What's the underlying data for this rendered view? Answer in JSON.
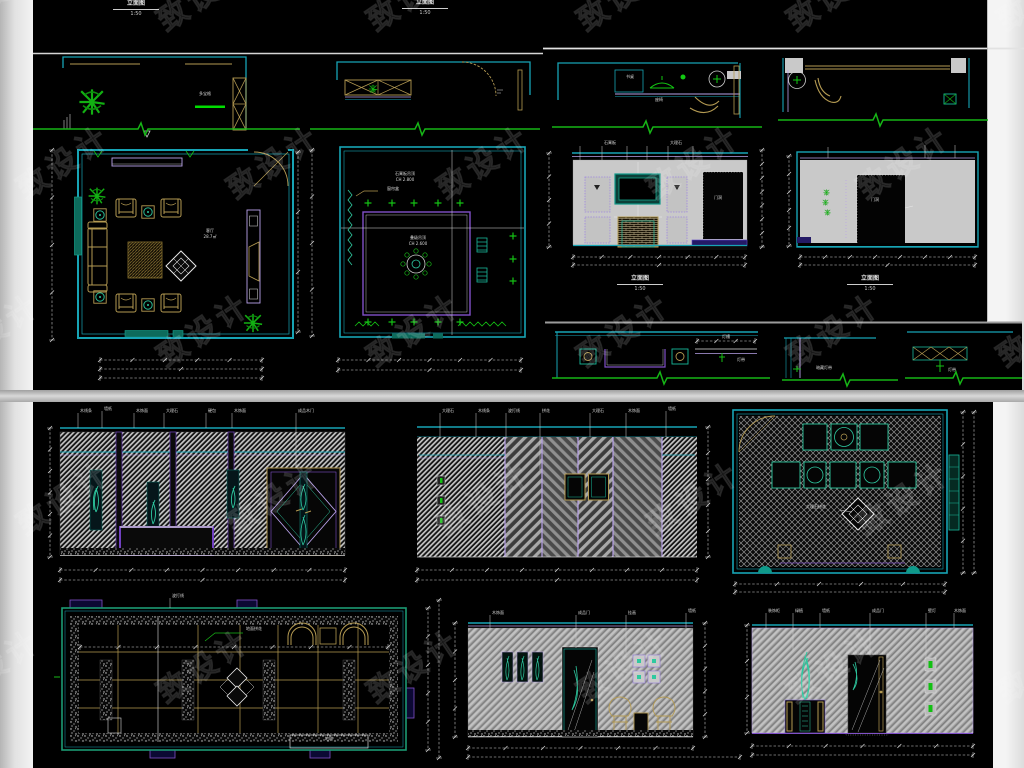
{
  "palette": {
    "sheet_bg": "#000000",
    "page_bg": "#e9e9e9",
    "wall_cyan": "#17a4b5",
    "teal": "#2ec9a0",
    "green": "#16b516",
    "tan": "#b49a52",
    "purple": "#8050c8",
    "lavender": "#b9a2ea",
    "dim_white": "#d8d8d8",
    "wall_gray": "#c9c9c9"
  },
  "watermark": {
    "text": "致设计"
  },
  "titles": {
    "top_title_1": {
      "name": "立面图",
      "scale": "1:50"
    },
    "top_title_2": {
      "name": "立面图",
      "scale": "1:50"
    },
    "elev_a": {
      "name": "立面图",
      "scale": "1:50"
    },
    "elev_b": {
      "name": "立面图",
      "scale": "1:50"
    }
  },
  "annotations": [
    {
      "x": 205,
      "y": 92,
      "t": "多宝格"
    },
    {
      "x": 626,
      "y": 75,
      "t": "书桌",
      "l": 1
    },
    {
      "x": 655,
      "y": 98,
      "t": "座椅",
      "l": 1
    },
    {
      "x": 210,
      "y": 229,
      "t": "客厅"
    },
    {
      "x": 210,
      "y": 235,
      "t": "28.7㎡"
    },
    {
      "x": 405,
      "y": 172,
      "t": "石膏板吊顶"
    },
    {
      "x": 405,
      "y": 178,
      "t": "CH 2.800"
    },
    {
      "x": 387,
      "y": 187,
      "t": "窗帘盒",
      "l": 1
    },
    {
      "x": 418,
      "y": 236,
      "t": "叠级吊顶"
    },
    {
      "x": 418,
      "y": 242,
      "t": "CH 2.600"
    },
    {
      "x": 714,
      "y": 196,
      "t": "门洞",
      "l": 1
    },
    {
      "x": 875,
      "y": 198,
      "t": "门洞"
    },
    {
      "x": 726,
      "y": 335,
      "t": "灯槽"
    },
    {
      "x": 737,
      "y": 358,
      "t": "灯带",
      "l": 1
    },
    {
      "x": 816,
      "y": 366,
      "t": "暗藏灯带",
      "l": 1
    },
    {
      "x": 948,
      "y": 368,
      "t": "灯带",
      "l": 1
    },
    {
      "x": 604,
      "y": 141,
      "t": "石膏板",
      "l": 1
    },
    {
      "x": 670,
      "y": 141,
      "t": "大理石",
      "l": 1
    },
    {
      "x": 80,
      "y": 409,
      "t": "木线条",
      "l": 1
    },
    {
      "x": 104,
      "y": 407,
      "t": "墙纸",
      "l": 1
    },
    {
      "x": 136,
      "y": 409,
      "t": "木饰面",
      "l": 1
    },
    {
      "x": 166,
      "y": 409,
      "t": "大理石",
      "l": 1
    },
    {
      "x": 208,
      "y": 409,
      "t": "硬包",
      "l": 1
    },
    {
      "x": 234,
      "y": 409,
      "t": "木饰面",
      "l": 1
    },
    {
      "x": 298,
      "y": 409,
      "t": "成品木门",
      "l": 1
    },
    {
      "x": 442,
      "y": 409,
      "t": "大理石",
      "l": 1
    },
    {
      "x": 478,
      "y": 409,
      "t": "木线条",
      "l": 1
    },
    {
      "x": 508,
      "y": 409,
      "t": "波打线",
      "l": 1
    },
    {
      "x": 542,
      "y": 409,
      "t": "拼花",
      "l": 1
    },
    {
      "x": 592,
      "y": 409,
      "t": "大理石",
      "l": 1
    },
    {
      "x": 628,
      "y": 409,
      "t": "木饰面",
      "l": 1
    },
    {
      "x": 668,
      "y": 407,
      "t": "墙纸",
      "l": 1
    },
    {
      "x": 806,
      "y": 505,
      "t": "大理石拼花",
      "l": 1
    },
    {
      "x": 246,
      "y": 627,
      "t": "地面拼花",
      "l": 1
    },
    {
      "x": 172,
      "y": 594,
      "t": "波打线",
      "l": 1
    },
    {
      "x": 329,
      "y": 737,
      "t": "地毯"
    },
    {
      "x": 492,
      "y": 611,
      "t": "木饰面",
      "l": 1
    },
    {
      "x": 578,
      "y": 611,
      "t": "成品门",
      "l": 1
    },
    {
      "x": 628,
      "y": 611,
      "t": "挂画",
      "l": 1
    },
    {
      "x": 688,
      "y": 609,
      "t": "墙纸",
      "l": 1
    },
    {
      "x": 768,
      "y": 609,
      "t": "装饰柜",
      "l": 1
    },
    {
      "x": 795,
      "y": 609,
      "t": "绿植",
      "l": 1
    },
    {
      "x": 822,
      "y": 609,
      "t": "墙纸",
      "l": 1
    },
    {
      "x": 872,
      "y": 609,
      "t": "成品门",
      "l": 1
    },
    {
      "x": 928,
      "y": 609,
      "t": "壁灯",
      "l": 1
    },
    {
      "x": 954,
      "y": 609,
      "t": "木饰面",
      "l": 1
    }
  ],
  "leaders": [
    [
      78,
      413,
      428
    ],
    [
      102,
      411,
      428
    ],
    [
      134,
      413,
      428
    ],
    [
      164,
      413,
      428
    ],
    [
      206,
      413,
      428
    ],
    [
      232,
      413,
      428
    ],
    [
      296,
      413,
      468
    ],
    [
      440,
      413,
      437
    ],
    [
      476,
      413,
      437
    ],
    [
      506,
      413,
      437
    ],
    [
      540,
      413,
      470
    ],
    [
      590,
      413,
      437
    ],
    [
      626,
      413,
      437
    ],
    [
      666,
      411,
      437
    ],
    [
      490,
      615,
      628
    ],
    [
      576,
      615,
      648
    ],
    [
      626,
      615,
      655
    ],
    [
      686,
      613,
      628
    ],
    [
      766,
      613,
      628
    ],
    [
      793,
      613,
      650
    ],
    [
      820,
      613,
      628
    ],
    [
      870,
      613,
      655
    ],
    [
      926,
      613,
      660
    ],
    [
      954,
      613,
      628
    ],
    [
      580,
      146,
      160
    ],
    [
      602,
      146,
      160
    ],
    [
      627,
      146,
      160
    ],
    [
      647,
      146,
      160
    ],
    [
      668,
      146,
      160
    ],
    [
      693,
      146,
      160
    ],
    [
      828,
      147,
      158
    ],
    [
      925,
      145,
      158
    ],
    [
      955,
      145,
      158
    ],
    [
      170,
      598,
      608
    ]
  ],
  "dims": [
    [
      100,
      360,
      262,
      360,
      5
    ],
    [
      100,
      369,
      262,
      369,
      2
    ],
    [
      100,
      378,
      262,
      378,
      1
    ],
    [
      52,
      150,
      52,
      340,
      4
    ],
    [
      298,
      152,
      298,
      332,
      3
    ],
    [
      338,
      360,
      521,
      360,
      6
    ],
    [
      338,
      370,
      521,
      370,
      2
    ],
    [
      312,
      150,
      312,
      336,
      4
    ],
    [
      573,
      257,
      745,
      257,
      6
    ],
    [
      573,
      265,
      745,
      265,
      2
    ],
    [
      549,
      153,
      549,
      247,
      4
    ],
    [
      762,
      150,
      762,
      247,
      7
    ],
    [
      800,
      257,
      975,
      257,
      7
    ],
    [
      800,
      265,
      975,
      265,
      2
    ],
    [
      789,
      156,
      789,
      246,
      5
    ],
    [
      697,
      341,
      755,
      341,
      3
    ],
    [
      60,
      570,
      345,
      570,
      8
    ],
    [
      60,
      580,
      345,
      580,
      2
    ],
    [
      50,
      428,
      50,
      557,
      6
    ],
    [
      417,
      570,
      697,
      570,
      8
    ],
    [
      417,
      580,
      697,
      580,
      2
    ],
    [
      708,
      427,
      708,
      557,
      5
    ],
    [
      963,
      412,
      963,
      573,
      5
    ],
    [
      974,
      412,
      974,
      573,
      1
    ],
    [
      735,
      584,
      945,
      584,
      5
    ],
    [
      735,
      592,
      945,
      592,
      1
    ],
    [
      80,
      647,
      388,
      647,
      8
    ],
    [
      428,
      608,
      428,
      750,
      5
    ],
    [
      439,
      600,
      439,
      758,
      1
    ],
    [
      468,
      748,
      693,
      748,
      6
    ],
    [
      468,
      757,
      740,
      757,
      1
    ],
    [
      705,
      623,
      705,
      737,
      5
    ],
    [
      752,
      746,
      973,
      746,
      6
    ],
    [
      752,
      755,
      973,
      755,
      1
    ],
    [
      455,
      623,
      455,
      737,
      4
    ],
    [
      747,
      625,
      747,
      733,
      3
    ]
  ],
  "grounds": [
    [
      33,
      129,
      300,
      143
    ],
    [
      310,
      129,
      540,
      420
    ],
    [
      552,
      127,
      762,
      648
    ],
    [
      778,
      120,
      988,
      878
    ],
    [
      552,
      378,
      770,
      662
    ],
    [
      782,
      380,
      898,
      845
    ],
    [
      905,
      378,
      1022,
      958
    ]
  ]
}
